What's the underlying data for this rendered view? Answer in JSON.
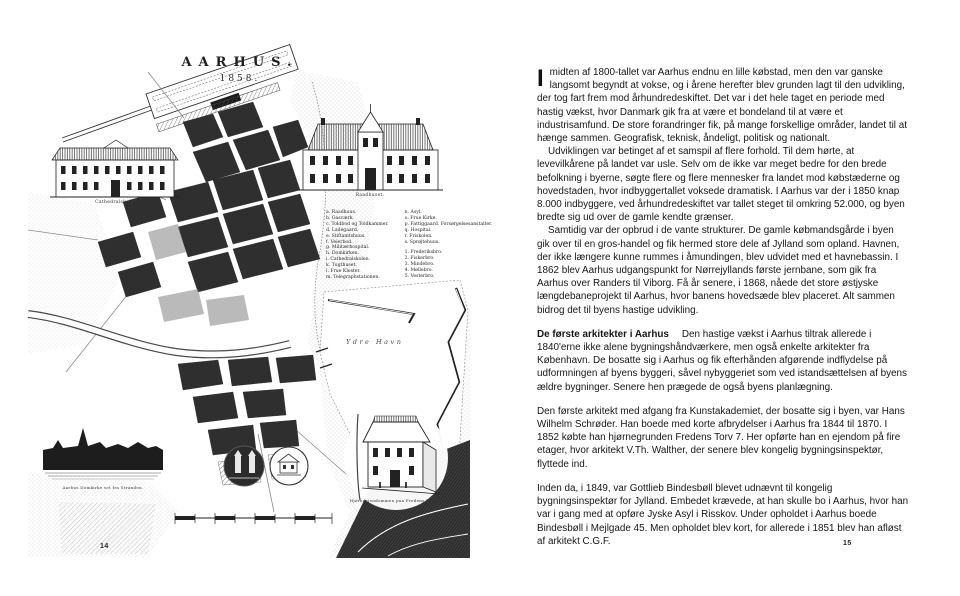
{
  "spread": {
    "left_page": {
      "page_number": "14",
      "map": {
        "title": "AARHUS.",
        "year": "1858.",
        "harbor_label": "Ydre Havn",
        "captions": {
          "school": "Cathedralskolen.",
          "townhall": "Raadhuset.",
          "panorama": "Aarhus Domkirke set fra Stranden.",
          "corner_house": "Hjørneejendommen paa Fredens Torv. V.Th."
        },
        "legend": {
          "col1": [
            "a. Raadhuus.",
            "b. Gasværk.",
            "c. Toldbod og Toldkammer.",
            "d. Ladegaard.",
            "e. Stiftamtshuus.",
            "f. Veierbod.",
            "g. Militærhospital.",
            "h. Domkirken.",
            "i. Cathedralskolen.",
            "k. Tugthuset.",
            "l. Frue Kloster.",
            "m. Telegraphstationen."
          ],
          "col2": [
            "n. Asyl.",
            "o. Frue Kirke.",
            "p. Fattiggaard.  Forsørgelsesanstalter.",
            "q. Hospital.",
            "r. Friskolen.",
            "s. Sprøjtehuus."
          ],
          "col2_numbered": [
            "1. Frederiksbro.",
            "2. Fiskerbro.",
            "3. Mindebro.",
            "4. Møllebro.",
            "5. Vesterbro."
          ]
        }
      }
    },
    "right_page": {
      "page_number": "15",
      "body": {
        "p1_dropcap": "I",
        "p1": "midten af 1800-tallet var Aarhus endnu en lille købstad, men den var ganske langsomt begyndt at vokse, og i årene herefter blev grunden lagt til den udvikling, der tog fart frem mod århundredeskiftet. Det var i det hele taget en periode med hastig vækst, hvor Danmark gik fra at være et bondeland til at være et industrisamfund. De store forandringer fik, på mange forskellige områder, landet til at hænge sammen. Geografisk, teknisk, åndeligt, politisk og nationalt.",
        "p2": "Udviklingen var betinget af et samspil af flere forhold. Til dem hørte, at levevilkårene på landet var usle. Selv om de ikke var meget bedre for den brede befolkning i byerne, søgte flere og flere mennesker fra landet mod købstæderne og hovedstaden, hvor indbyggertallet voksede dramatisk. I Aarhus var der i 1850 knap 8.000 indbyggere, ved århundredeskiftet var tallet steget til omkring 52.000, og byen bredte sig ud over de gamle kendte grænser.",
        "p3": "Samtidig var der opbrud i de vante strukturer. De gamle købmandsgårde i byen gik over til en gros-handel og fik hermed store dele af Jylland som opland. Havnen, der ikke længere kunne rummes i åmundingen, blev udvidet med et havnebassin. I 1862 blev Aarhus udgangspunkt for Nørrejyllands første jernbane, som gik fra Aarhus over Randers til Viborg. Få år senere, i 1868, nåede det store østjyske længdebaneprojekt til Aarhus, hvor banens hovedsæde blev placeret. Alt sammen bidrog det til byens hastige udvikling.",
        "section_heading": "De første arkitekter i Aarhus",
        "p4": "Den hastige vækst i Aarhus tiltrak allerede i 1840'erne ikke alene bygningshåndværkere, men også enkelte arkitekter fra København. De bosatte sig i Aarhus og fik efterhånden afgørende indflydelse på udformningen af byens byggeri, såvel nybyggeriet som ved istandsættelsen af byens ældre bygninger. Senere hen prægede de også byens planlægning.",
        "p5": "Den første arkitekt med afgang fra Kunstakademiet, der bosatte sig i byen, var Hans Wilhelm Schrøder. Han boede med korte afbrydelser i Aarhus fra 1844 til 1870. I 1852 købte han hjørnegrunden Fredens Torv 7. Her opførte han en ejendom på fire etager, hvor arkitekt V.Th. Walther, der senere blev kongelig bygningsinspektør, flyttede ind.",
        "p6": "Inden da, i 1849, var Gottlieb Bindesbøll blevet udnævnt til kongelig bygningsinspektør for Jylland. Embedet krævede, at han skulle bo i Aarhus, hvor han var i gang med at opføre Jyske Asyl i Risskov. Under opholdet i Aarhus boede Bindesbøll i Mejlgade 45. Men opholdet blev kort, for allerede i 1851 blev han afløst af arkitekt C.G.F."
      }
    }
  }
}
